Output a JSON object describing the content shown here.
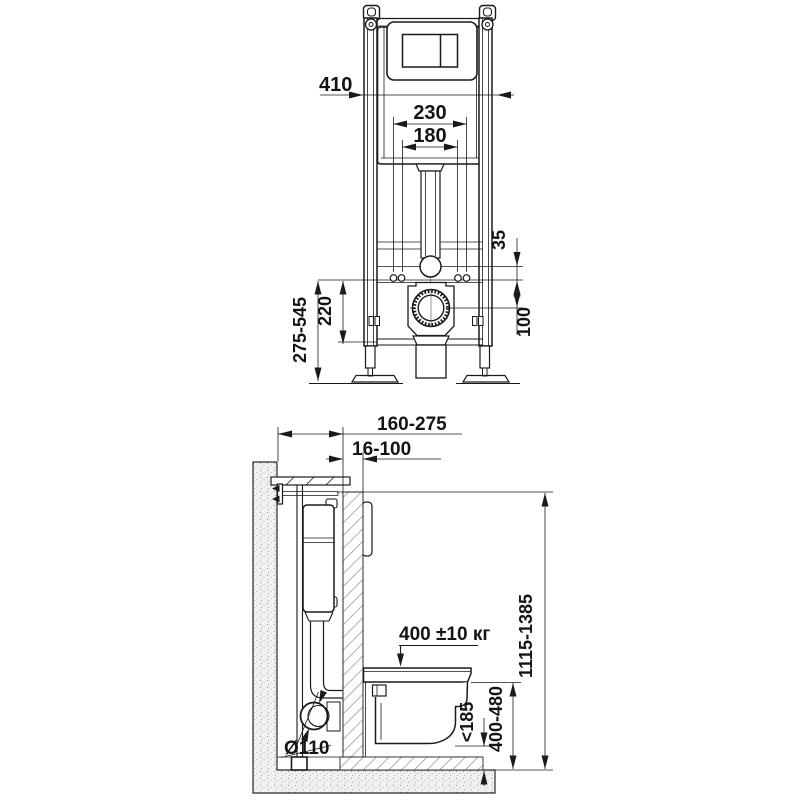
{
  "drawing": {
    "description": "Installation frame for wall-hung toilet, front view and side view with dimensions (mm)",
    "line_color": "#1a1a1a",
    "front_view": {
      "dims": {
        "frame_width": "410",
        "fixing_spacing_outer": "230",
        "fixing_spacing_inner": "180",
        "supply_to_fixings": "35",
        "fixings_to_drain": "100",
        "fixings_height": "220",
        "adjustable_height": "275-545"
      }
    },
    "side_view": {
      "dims": {
        "installation_depth": "160-275",
        "cladding_thickness": "16-100",
        "max_load": "400 ±10 кг",
        "frame_height": "1115-1385",
        "bowl_height": "400-480",
        "drain_height": "<185",
        "drain_pipe_diameter": "Ø110"
      }
    }
  }
}
